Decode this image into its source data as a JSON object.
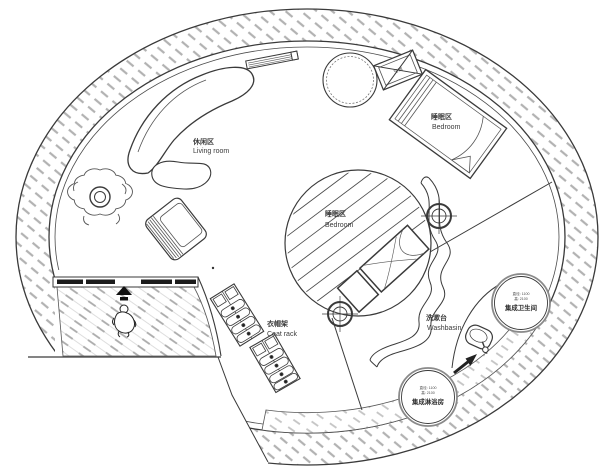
{
  "plan": {
    "title": "circular-tiny-house-floor-plan",
    "labels": {
      "living_zh": "休闲区",
      "living_en": "Living room",
      "bedroom_upper_zh": "睡眠区",
      "bedroom_upper_en": "Bedroom",
      "bedroom_center_zh": "睡眠区",
      "bedroom_center_en": "Bedroom",
      "coatrack_zh": "衣帽架",
      "coatrack_en": "Coat rack",
      "washbasin_zh": "洗漱台",
      "washbasin_en": "Washbasin",
      "bathroom_label": "集成卫生间",
      "bathroom_dim1": "直径: 1100",
      "bathroom_dim2": "高: 2100",
      "shower_label": "集成淋浴房",
      "shower_dim1": "直径: 1100",
      "shower_dim2": "高: 2100",
      "ac_label": "空调"
    },
    "colors": {
      "line": "#3a3a3a",
      "wall_hatch": "#b2b2b2",
      "deck_hatch": "#ababab",
      "band_hatch": "#c4c4c4",
      "window_fill": "#1c1c1c",
      "text": "#3a3a3a",
      "bg": "#ffffff"
    }
  }
}
